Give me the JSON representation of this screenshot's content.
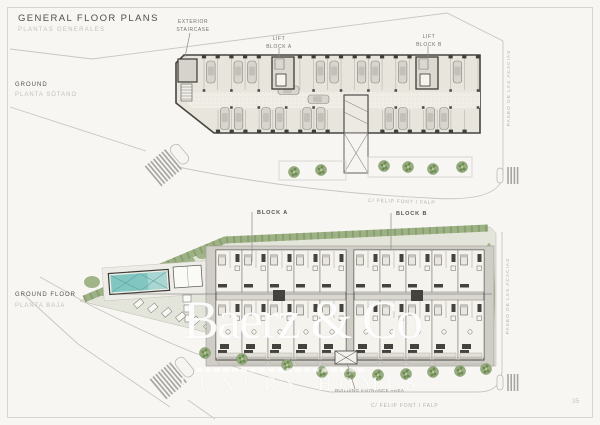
{
  "page": {
    "title": "GENERAL FLOOR PLANS",
    "subtitle": "PLANTAS GENERALES",
    "number": "35"
  },
  "plans": {
    "basement": {
      "label": "GROUND",
      "sublabel": "PLANTA SÓTANO"
    },
    "ground": {
      "label": "GROUND FLOOR",
      "sublabel": "PLANTA BAJA"
    }
  },
  "annotations": {
    "exterior_staircase": "EXTERIOR\nSTAIRCASE",
    "lift_block_a": "LIFT\nBLOCK A",
    "lift_block_b": "LIFT\nBLOCK B",
    "block_a": "BLOCK A",
    "block_b": "BLOCK B",
    "building_entrance": "BUILDING ENTRANCE AREA"
  },
  "streets": {
    "paseo": "PASEO DE LAS ACACIAS",
    "felip": "C/ FELIP FONT I FALP"
  },
  "watermark": {
    "brand": "Baerz & Co",
    "tagline": "LUXURY HOMES"
  },
  "colors": {
    "pool_water": "#82c6c2",
    "landscape_green": "#97ad7e",
    "wall_dark": "#3f3d39",
    "plan_fill": "#e8e5dd"
  }
}
